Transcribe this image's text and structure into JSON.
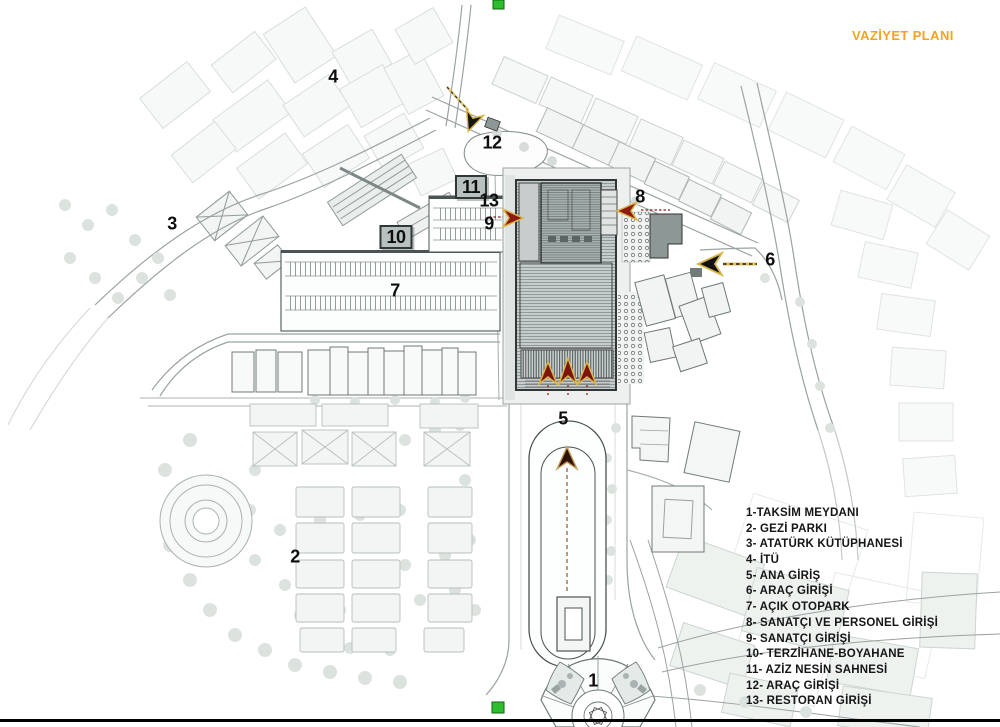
{
  "title": {
    "text": "VAZİYET PLANI"
  },
  "legend": {
    "items": [
      {
        "num": "1",
        "text": "1-TAKSİM MEYDANI"
      },
      {
        "num": "2",
        "text": "2- GEZİ PARKI"
      },
      {
        "num": "3",
        "text": "3- ATATÜRK KÜTÜPHANESİ"
      },
      {
        "num": "4",
        "text": "4- İTÜ"
      },
      {
        "num": "5",
        "text": "5- ANA GİRİŞ"
      },
      {
        "num": "6",
        "text": "6- ARAÇ GİRİŞİ"
      },
      {
        "num": "7",
        "text": "7- AÇIK OTOPARK"
      },
      {
        "num": "8",
        "text": "8- SANATÇI VE PERSONEL GİRİŞİ"
      },
      {
        "num": "9",
        "text": "9- SANATÇI GİRİŞİ"
      },
      {
        "num": "10",
        "text": "10- TERZİHANE-BOYAHANE"
      },
      {
        "num": "11",
        "text": "11- AZİZ NESİN SAHNESİ"
      },
      {
        "num": "12",
        "text": "12- ARAÇ GİRİŞİ"
      },
      {
        "num": "13",
        "text": "13- RESTORAN GİRİŞİ"
      }
    ]
  },
  "map": {
    "markers": [
      {
        "label": "1",
        "x": 593,
        "y": 681,
        "boxed": false
      },
      {
        "label": "2",
        "x": 295,
        "y": 557,
        "boxed": false
      },
      {
        "label": "3",
        "x": 172,
        "y": 224,
        "boxed": false
      },
      {
        "label": "4",
        "x": 333,
        "y": 77,
        "boxed": false
      },
      {
        "label": "5",
        "x": 563,
        "y": 419,
        "boxed": false
      },
      {
        "label": "6",
        "x": 770,
        "y": 260,
        "boxed": false
      },
      {
        "label": "7",
        "x": 395,
        "y": 291,
        "boxed": false
      },
      {
        "label": "8",
        "x": 640,
        "y": 197,
        "boxed": false
      },
      {
        "label": "9",
        "x": 489,
        "y": 224,
        "boxed": false
      },
      {
        "label": "10",
        "x": 396,
        "y": 237,
        "boxed": true
      },
      {
        "label": "11",
        "x": 471,
        "y": 187,
        "boxed": true
      },
      {
        "label": "12",
        "x": 492,
        "y": 143,
        "boxed": false
      },
      {
        "label": "13",
        "x": 489,
        "y": 201,
        "boxed": false
      }
    ]
  },
  "colors": {
    "title_orange": "#F6A21F",
    "arrow_dark_red": "#7D150D",
    "arrow_black": "#1A1A1A",
    "arrow_outline_gold": "#D9B64A",
    "marker_box_fill": "#B9C1C0",
    "building_dark_gray": "#8D9796",
    "building_hatch_gray": "#C6CDCC",
    "tree_gray": "#DCE3DF",
    "green_marker": "#2EBD2E"
  }
}
